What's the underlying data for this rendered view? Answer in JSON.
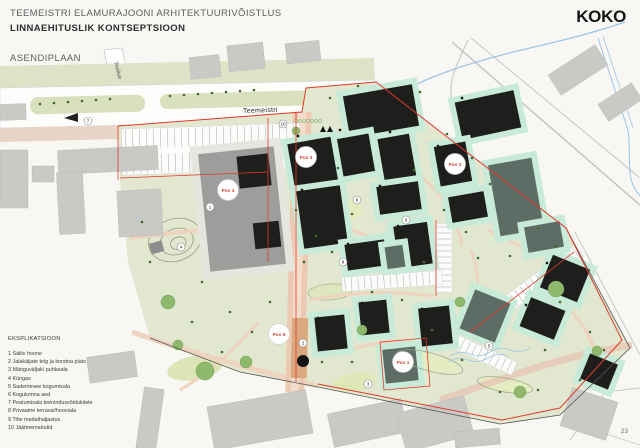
{
  "header": {
    "title_line1": "TEEMEISTRI ELAMURAJOONI ARHITEKTUURIVÕISTLUS",
    "title_line2": "LINNAEHITUSLIK KONTSEPTSIOON",
    "subtitle": "ASENDIPLAAN"
  },
  "logo": {
    "text": "KOKO"
  },
  "page_number": "23",
  "legend": {
    "title": "EKSPLIKATSIOON",
    "items": [
      "1 Säiliv hoone",
      "2 Jalakäijate telg ja korstna plats",
      "3 Mänguväljak/ puhkeala",
      "4 Küngas",
      "5 Sademevee kogumisala",
      "6 Kogukonna aed",
      "7 Peatumisala teenindussõidukitele",
      "8 Privaatne terrassi/hooviala",
      "9 Tihe madalhaljastus",
      "10 Jäätmemahutid"
    ]
  },
  "map": {
    "street_labels": {
      "main": "Teemeistri",
      "side": "Teelise"
    },
    "pos_markers": [
      {
        "label": "Pos 1"
      },
      {
        "label": "Pos 2"
      },
      {
        "label": "Pos 3"
      },
      {
        "label": "Pos 4"
      },
      {
        "label": "Pos 5"
      }
    ],
    "number_markers": [
      "1",
      "2",
      "3",
      "4",
      "5",
      "6",
      "7",
      "8",
      "9",
      "10"
    ],
    "colors": {
      "site_green": "#e2e7cf",
      "pad_mint": "#c8ead8",
      "building_black": "#1e1e1c",
      "building_slate": "#5e6c66",
      "existing_gray": "#9d9d9b",
      "path_salmon": "#ecc9b3",
      "boundary_red": "#e03a2b",
      "water_blue": "#9bc5e6"
    }
  }
}
